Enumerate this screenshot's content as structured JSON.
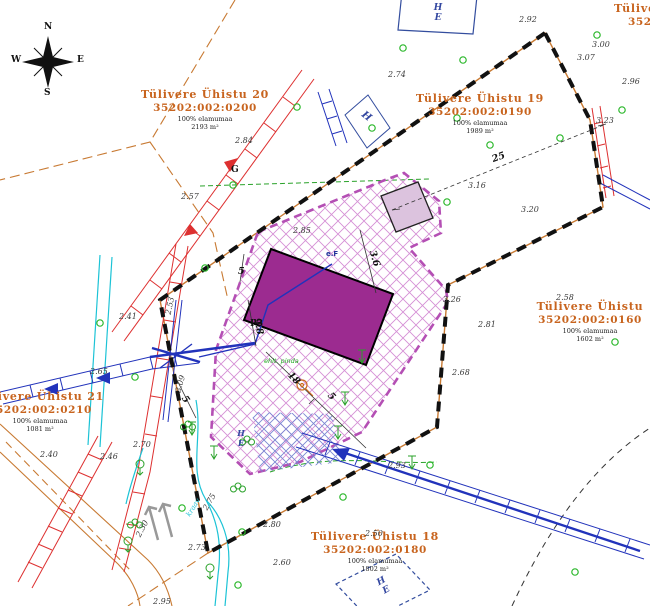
{
  "map": {
    "compass": {
      "n": "N",
      "e": "E",
      "s": "S",
      "w": "W"
    },
    "parcels": [
      {
        "name": "Tülivere Ühistu 20",
        "code": "35202:002:0200",
        "use": "100% elamumaa",
        "area": "2193 m²"
      },
      {
        "name": "Tülivere Ühistu 19",
        "code": "35202:002:0190",
        "use": "100% elamumaa",
        "area": "1989 m²"
      },
      {
        "name": "Tülivere Ühistu",
        "code": "35202:002:0160",
        "use": "100% elamumaa",
        "area": "1602 m²"
      },
      {
        "name": "Tülivere Ühistu 18",
        "code": "35202:002:0180",
        "use": "100% elamumaa",
        "area": "1802 m²"
      },
      {
        "name": "Tülivere Ühistu 21",
        "code": "35202:002:0210",
        "use": "100% elamumaa",
        "area": "1081 m²"
      },
      {
        "name": "Tülivere",
        "code": "35202:002"
      }
    ],
    "markers": {
      "g_point": "G",
      "p3": "P3",
      "ef": "e.F",
      "ehit": "ehit. pinda",
      "kraav": "kraav",
      "he_top": "H\nE",
      "h_mid": "H",
      "he_yard": "H\nE",
      "he_bottom": "H\nE"
    },
    "elevations": [
      {
        "x": 519,
        "y": 15,
        "v": "2.92"
      },
      {
        "x": 388,
        "y": 70,
        "v": "2.74"
      },
      {
        "x": 592,
        "y": 40,
        "v": "3.00"
      },
      {
        "x": 577,
        "y": 53,
        "v": "3.07"
      },
      {
        "x": 622,
        "y": 77,
        "v": "2.96"
      },
      {
        "x": 596,
        "y": 116,
        "v": "3.23"
      },
      {
        "x": 235,
        "y": 136,
        "v": "2.84"
      },
      {
        "x": 181,
        "y": 192,
        "v": "2.57"
      },
      {
        "x": 468,
        "y": 181,
        "v": "3.16"
      },
      {
        "x": 521,
        "y": 205,
        "v": "3.20"
      },
      {
        "x": 293,
        "y": 226,
        "v": "2.85"
      },
      {
        "x": 556,
        "y": 293,
        "v": "2.58"
      },
      {
        "x": 452,
        "y": 368,
        "v": "2.68"
      },
      {
        "x": 478,
        "y": 320,
        "v": "2.81"
      },
      {
        "x": 443,
        "y": 295,
        "v": "3.26"
      },
      {
        "x": 90,
        "y": 367,
        "v": "2.65"
      },
      {
        "x": 119,
        "y": 312,
        "v": "2.41"
      },
      {
        "x": 100,
        "y": 452,
        "v": "2.46"
      },
      {
        "x": 40,
        "y": 450,
        "v": "2.40"
      },
      {
        "x": 133,
        "y": 440,
        "v": "2.70"
      },
      {
        "x": 263,
        "y": 520,
        "v": "2.80"
      },
      {
        "x": 273,
        "y": 558,
        "v": "2.60"
      },
      {
        "x": 365,
        "y": 529,
        "v": "2.50"
      },
      {
        "x": 388,
        "y": 461,
        "v": "2.93"
      },
      {
        "x": 153,
        "y": 597,
        "v": "2.95"
      },
      {
        "x": 188,
        "y": 543,
        "v": "2.73"
      },
      {
        "x": 168,
        "y": 310,
        "v": "2.53",
        "r": -78
      },
      {
        "x": 178,
        "y": 388,
        "v": "3.09",
        "r": -75
      },
      {
        "x": 205,
        "y": 505,
        "v": "2.75",
        "r": -60
      },
      {
        "x": 138,
        "y": 532,
        "v": "2.30",
        "r": -62
      }
    ],
    "dimensions": [
      {
        "x": 492,
        "y": 152,
        "v": "25",
        "r": -20
      },
      {
        "x": 366,
        "y": 253,
        "v": "3.6",
        "r": 73
      },
      {
        "x": 287,
        "y": 373,
        "v": "18",
        "r": 46
      },
      {
        "x": 328,
        "y": 391,
        "v": "5",
        "r": 46
      },
      {
        "x": 238,
        "y": 266,
        "v": "5",
        "r": 0
      },
      {
        "x": 250,
        "y": 321,
        "v": "9.8",
        "r": 78
      },
      {
        "x": 182,
        "y": 394,
        "v": "5",
        "r": 55
      }
    ],
    "green_points": [
      [
        403,
        48
      ],
      [
        463,
        60
      ],
      [
        297,
        107
      ],
      [
        372,
        128
      ],
      [
        597,
        35
      ],
      [
        622,
        110
      ],
      [
        233,
        185
      ],
      [
        490,
        145
      ],
      [
        447,
        202
      ],
      [
        205,
        268
      ],
      [
        100,
        323
      ],
      [
        135,
        377
      ],
      [
        182,
        508
      ],
      [
        242,
        532
      ],
      [
        457,
        118
      ],
      [
        560,
        138
      ],
      [
        430,
        465
      ],
      [
        238,
        585
      ],
      [
        343,
        497
      ],
      [
        575,
        572
      ],
      [
        615,
        342
      ]
    ],
    "symbols": [
      {
        "t": "bush",
        "x": 188,
        "y": 425
      },
      {
        "t": "bush",
        "x": 247,
        "y": 440
      },
      {
        "t": "bush",
        "x": 238,
        "y": 487
      },
      {
        "t": "bush",
        "x": 135,
        "y": 523
      },
      {
        "t": "tree",
        "x": 128,
        "y": 545
      },
      {
        "t": "tree",
        "x": 210,
        "y": 572
      },
      {
        "t": "tree",
        "x": 140,
        "y": 468
      },
      {
        "t": "varrow",
        "x": 362,
        "y": 356
      },
      {
        "t": "varrow",
        "x": 192,
        "y": 428
      },
      {
        "t": "varrow",
        "x": 214,
        "y": 452
      },
      {
        "t": "varrow",
        "x": 338,
        "y": 432
      },
      {
        "t": "varrow",
        "x": 412,
        "y": 462
      },
      {
        "t": "varrow",
        "x": 345,
        "y": 398
      }
    ],
    "colors": {
      "boundary": "#111111",
      "parcel_line": "#c87a33",
      "parcel_label": "#c8641e",
      "yard_outline": "#b44fb4",
      "building_fill": "#9c2b90",
      "small_building_fill": "#dcc3de",
      "power_line": "#dd3030",
      "cable_line": "#2233bb",
      "water_line": "#1cc3d6",
      "vegetation": "#22aa22"
    }
  }
}
